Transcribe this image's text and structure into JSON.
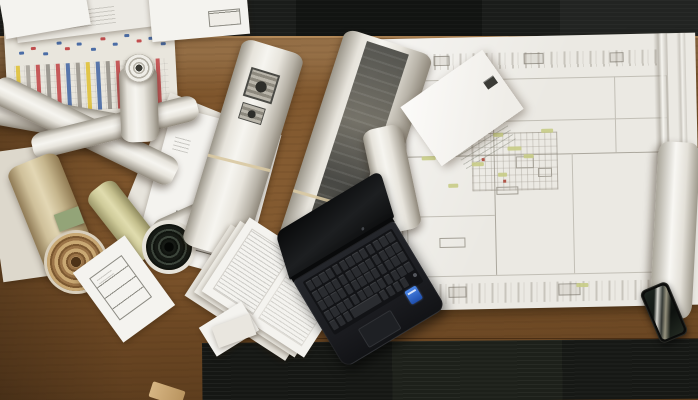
{
  "scene": {
    "description": "Top-down photograph of a wooden architect's desk on dark carpet, covered with rolled blueprints, stacked technical drawings, a colour-coded schedule printout, a large architectural floor plan with green highlights and a white envelope on it, an open black laptop with a blue Intel sticker, and a smartphone with screen reflections at the desk edge.",
    "objects": [
      "dark-carpet",
      "wooden-desk",
      "bar-chart-printout",
      "paper-stacks",
      "rolled-blueprints",
      "kraft-roll",
      "sage-roll",
      "printed-rolls",
      "architectural-floor-plan",
      "white-envelope",
      "form-sheet",
      "fanned-report-pages",
      "open-laptop",
      "intel-sticker",
      "smartphone",
      "paper-scrap"
    ]
  },
  "palette": {
    "carpet": "#1a1c1a",
    "wood": "#7b5229",
    "wood_light": "#9a6e3c",
    "wood_dark": "#5f3e1f",
    "paper": "#eceae4",
    "paper_bright": "#f4f3ef",
    "plan_line": "#c2bfb6",
    "highlight_green": "#c8cc86",
    "laptop_body": "#1e2023",
    "laptop_key": "#2a2c30",
    "intel_blue": "#2f6fd8",
    "tan": "#c2996a",
    "sage": "#d9d6a4"
  },
  "chart_paper": {
    "stripes": [
      "#dfc23c",
      "#a9a59b",
      "#c24e4e",
      "#96938a",
      "#c24e4e",
      "#4b6da6",
      "#9a968c",
      "#dfc23c",
      "#4b6da6",
      "#96938a",
      "#c24e4e",
      "#a9a59b",
      "#dfc23c",
      "#4b6da6",
      "#c24e4e"
    ],
    "marks": [
      {
        "x": 6,
        "y": 20,
        "c": "#4b6da6"
      },
      {
        "x": 18,
        "y": 16,
        "c": "#c24e4e"
      },
      {
        "x": 30,
        "y": 22,
        "c": "#4b6da6"
      },
      {
        "x": 44,
        "y": 12,
        "c": "#4b6da6"
      },
      {
        "x": 52,
        "y": 18,
        "c": "#c24e4e"
      },
      {
        "x": 64,
        "y": 14,
        "c": "#4b6da6"
      },
      {
        "x": 78,
        "y": 20,
        "c": "#4b6da6"
      },
      {
        "x": 88,
        "y": 10,
        "c": "#c24e4e"
      },
      {
        "x": 100,
        "y": 16,
        "c": "#4b6da6"
      },
      {
        "x": 112,
        "y": 8,
        "c": "#4b6da6"
      },
      {
        "x": 124,
        "y": 14,
        "c": "#c24e4e"
      },
      {
        "x": 136,
        "y": 12,
        "c": "#4b6da6"
      },
      {
        "x": 148,
        "y": 18,
        "c": "#4b6da6"
      }
    ]
  },
  "laptop": {
    "keyboard": {
      "rows": 4,
      "cols": 13,
      "space_row": [
        8,
        8,
        8,
        34,
        8,
        8,
        8,
        8
      ]
    }
  },
  "plan": {
    "highlights": [
      {
        "x": 46,
        "y": 118,
        "w": 14
      },
      {
        "x": 72,
        "y": 146,
        "w": 10
      },
      {
        "x": 96,
        "y": 125,
        "w": 12
      },
      {
        "x": 118,
        "y": 96,
        "w": 10
      },
      {
        "x": 132,
        "y": 110,
        "w": 14
      },
      {
        "x": 148,
        "y": 118,
        "w": 10
      },
      {
        "x": 166,
        "y": 93,
        "w": 12
      },
      {
        "x": 122,
        "y": 136,
        "w": 9
      },
      {
        "x": 198,
        "y": 248,
        "w": 12
      },
      {
        "x": 40,
        "y": 60,
        "w": 10
      }
    ],
    "red_marks": [
      {
        "x": 106,
        "y": 121
      },
      {
        "x": 127,
        "y": 143
      }
    ]
  }
}
